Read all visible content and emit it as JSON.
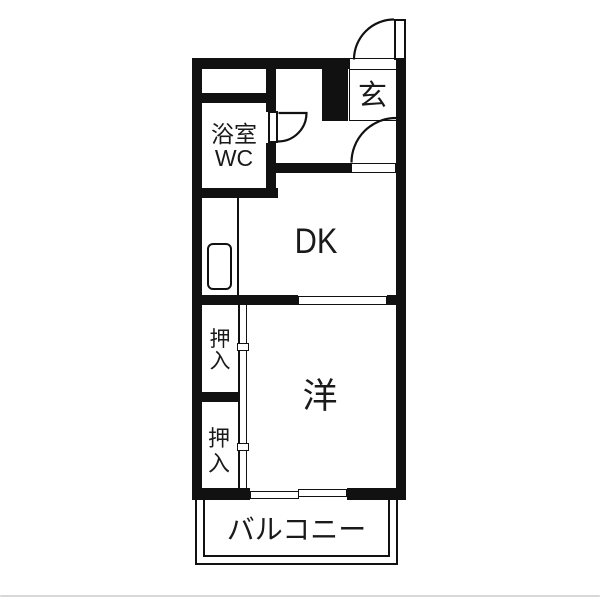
{
  "colors": {
    "wall": "#111111",
    "line": "#1a1a1a",
    "background": "#ffffff",
    "divider": "#d8d8d8"
  },
  "labels": {
    "bath_line1": "浴室",
    "bath_line2": "WC",
    "entrance": "玄",
    "dining_kitchen": "DK",
    "western_room": "洋",
    "closet_upper_line1": "押",
    "closet_upper_line2": "入",
    "closet_lower_line1": "押",
    "closet_lower_line2": "入",
    "balcony": "バルコニー"
  }
}
